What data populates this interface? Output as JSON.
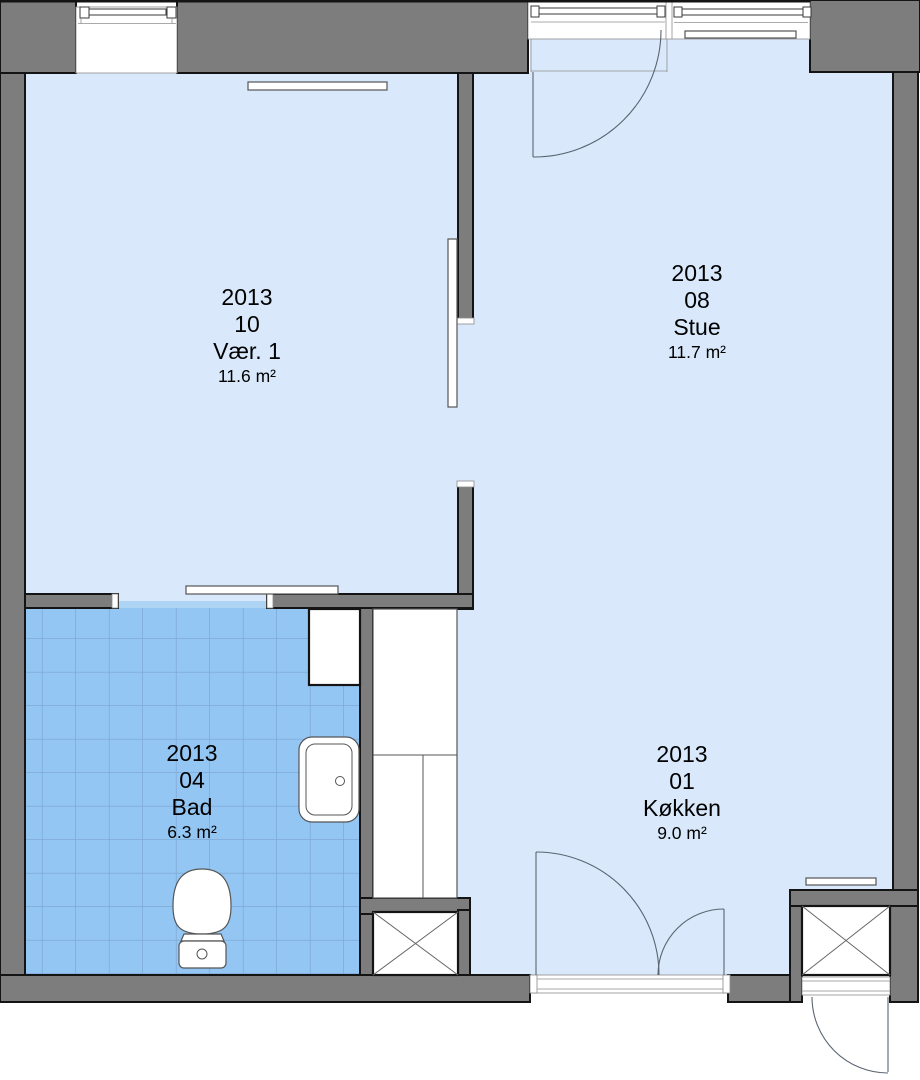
{
  "plan": {
    "type": "floor-plan",
    "rooms": [
      {
        "year": "2013",
        "number": "10",
        "name": "Vær. 1",
        "area": "11.6 m²"
      },
      {
        "year": "2013",
        "number": "08",
        "name": "Stue",
        "area": "11.7 m²"
      },
      {
        "year": "2013",
        "number": "04",
        "name": "Bad",
        "area": "6.3 m²"
      },
      {
        "year": "2013",
        "number": "01",
        "name": "Køkken",
        "area": "9.0 m²"
      }
    ],
    "colors": {
      "wall": "#7d7d7d",
      "outline": "#141414",
      "floor": "#d9e9fb",
      "tile": "#93c6f3",
      "tile_grid": "#7ba3cd",
      "threshold": "#aed4f4",
      "fixture_stroke": "#555555",
      "swing_stroke": "#5a6470"
    },
    "icons": [
      "window-icon",
      "door-swing-icon",
      "double-door-icon",
      "sliding-door-icon",
      "radiator-icon",
      "toilet-icon",
      "sink-icon",
      "washer-icon",
      "kitchen-counter-icon",
      "shaft-x-icon"
    ]
  }
}
